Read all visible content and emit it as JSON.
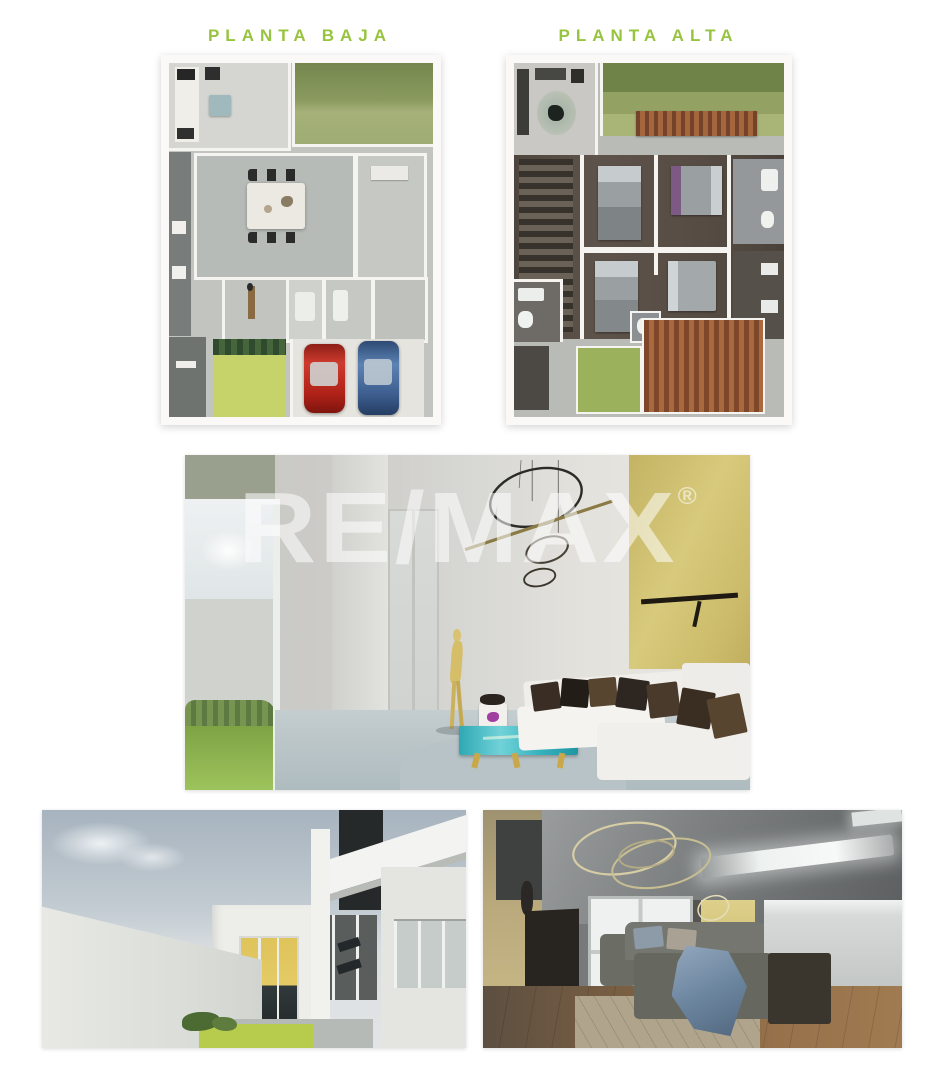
{
  "page": {
    "background": "#ffffff",
    "accent_green": "#97c43e"
  },
  "floor_plans": {
    "ground": {
      "title": "PLANTA BAJA"
    },
    "upper": {
      "title": "PLANTA ALTA"
    }
  },
  "watermark": {
    "brand": "RE/MAX",
    "registered_mark": "®",
    "color": "#ffffff"
  }
}
